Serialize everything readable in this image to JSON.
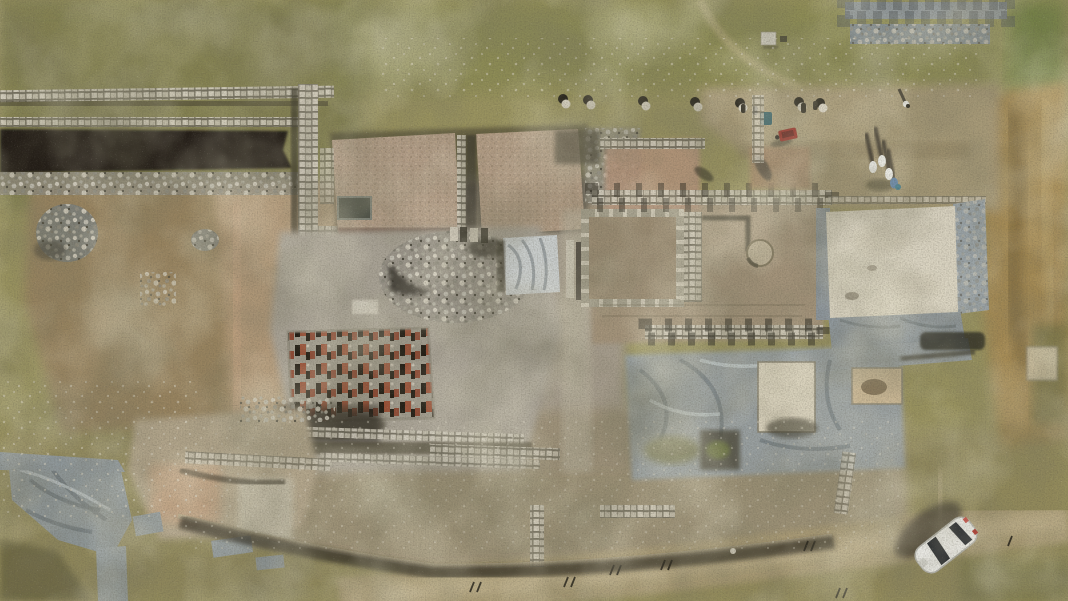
{
  "scene": {
    "kind": "aerial-drone-photograph",
    "subject": "archaeological excavation site seen from directly overhead",
    "description": "Top-down drone photograph of a large archaeological dig in dry late-summer scrubland. Excavated stone wall foundations and trenches, two flat gravel-covered terraces, a grid of small red hypocaust brick pillars, silver and grey protective tarpaulins, and a cream plaster-capped square floor are visible. A small group of people stands in the north-east sector casting long shadows, a red wheelbarrow sits at a trench edge, and a single white car is parked on the dirt track crossing the bottom of the frame."
  },
  "objects": {
    "people_group": {
      "count": 4,
      "clothing": "white and blue",
      "location": "upper right, long shadows pointing up-left"
    },
    "lone_walker": {
      "count": 1,
      "location": "top right"
    },
    "car": {
      "count": 1,
      "color": "white",
      "heading": "front toward lower-left",
      "location": "bottom-right dirt track"
    },
    "wheelbarrow": {
      "count": 1,
      "color": "red",
      "location": "north trench edge, centre-right"
    },
    "gravel_terraces": {
      "count": 2,
      "location": "upper centre"
    },
    "hypocaust_brick_grid": {
      "location": "centre",
      "note": "rows of small red-brick pilae casting shadows"
    },
    "covered_floor": {
      "color": "cream",
      "border": "grey tarpaulin",
      "location": "right of centre"
    },
    "silver_tarp": {
      "location": "centre, draped over trench"
    },
    "grey_tarps": {
      "locations": [
        "south of covered floor",
        "south-west corner"
      ]
    },
    "stone_rubble_piles": {
      "count": 2,
      "location": "upper-left clearing"
    },
    "dirt_track": {
      "location": "bottom edge, curving toward right"
    },
    "survey_pegs": {
      "note": "small dark markers scattered along the track"
    }
  },
  "palette": {
    "grass": "#99935f",
    "grass_dark": "#7d7c4e",
    "grass_green": "#7c8148",
    "dry_grass_gold": "#a58a52",
    "dirt": "#a3937a",
    "dirt_pink": "#b59c7c",
    "clearing_pale": "#b3a68c",
    "stone_light": "#d3cec0",
    "rubble_grey": "#8e8b80",
    "trench_shadow": "#23211a",
    "gravel_pad": "#b39e88",
    "brick_red": "#9a5137",
    "tarp_grey": "#98a0a3",
    "tarp_silver": "#c9cdcc",
    "plaster_cream": "#d9d3c1",
    "road": "#b0a17c",
    "car_white": "#f2f2ee",
    "wheelbarrow_red": "#93231c",
    "shadow_dark": "#2b281d"
  }
}
